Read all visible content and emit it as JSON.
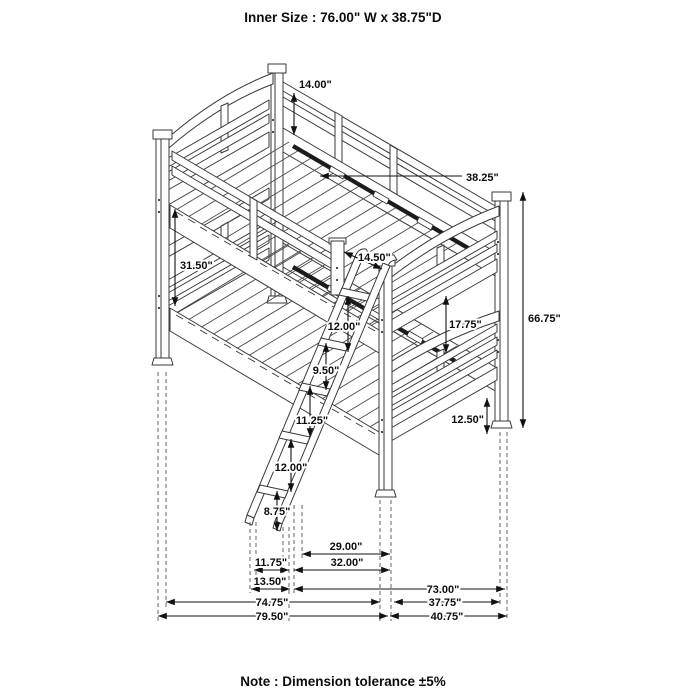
{
  "header": {
    "inner_size": "Inner Size : 76.00\" W x  38.75\"D"
  },
  "note": {
    "text": "Note : Dimension tolerance ±5%"
  },
  "dims": {
    "headboard_top": "14.00\"",
    "inner_depth": "38.25\"",
    "bunk_spacing": "31.50\"",
    "ladder_opening": "14.50\"",
    "overall_height": "66.75\"",
    "guard_to_surface": "17.75\"",
    "rung_space_1": "12.00\"",
    "rung_space_2": "9.50\"",
    "rung_space_3": "11.25\"",
    "rung_space_4": "12.00\"",
    "rung_space_5": "8.75\"",
    "footboard_panel": "12.50\"",
    "ladder_top_span": "29.00\"",
    "ladder_base_span": "32.00\"",
    "ladder_foot_inner": "11.75\"",
    "ladder_foot_outer": "13.50\"",
    "floor_clear_span": "73.00\"",
    "length_inner": "74.75\"",
    "depth_inner": "37.75\"",
    "length_overall": "79.50\"",
    "depth_overall": "40.75\""
  },
  "drawing": {
    "subject": "bunk-bed-dimension-diagram"
  }
}
